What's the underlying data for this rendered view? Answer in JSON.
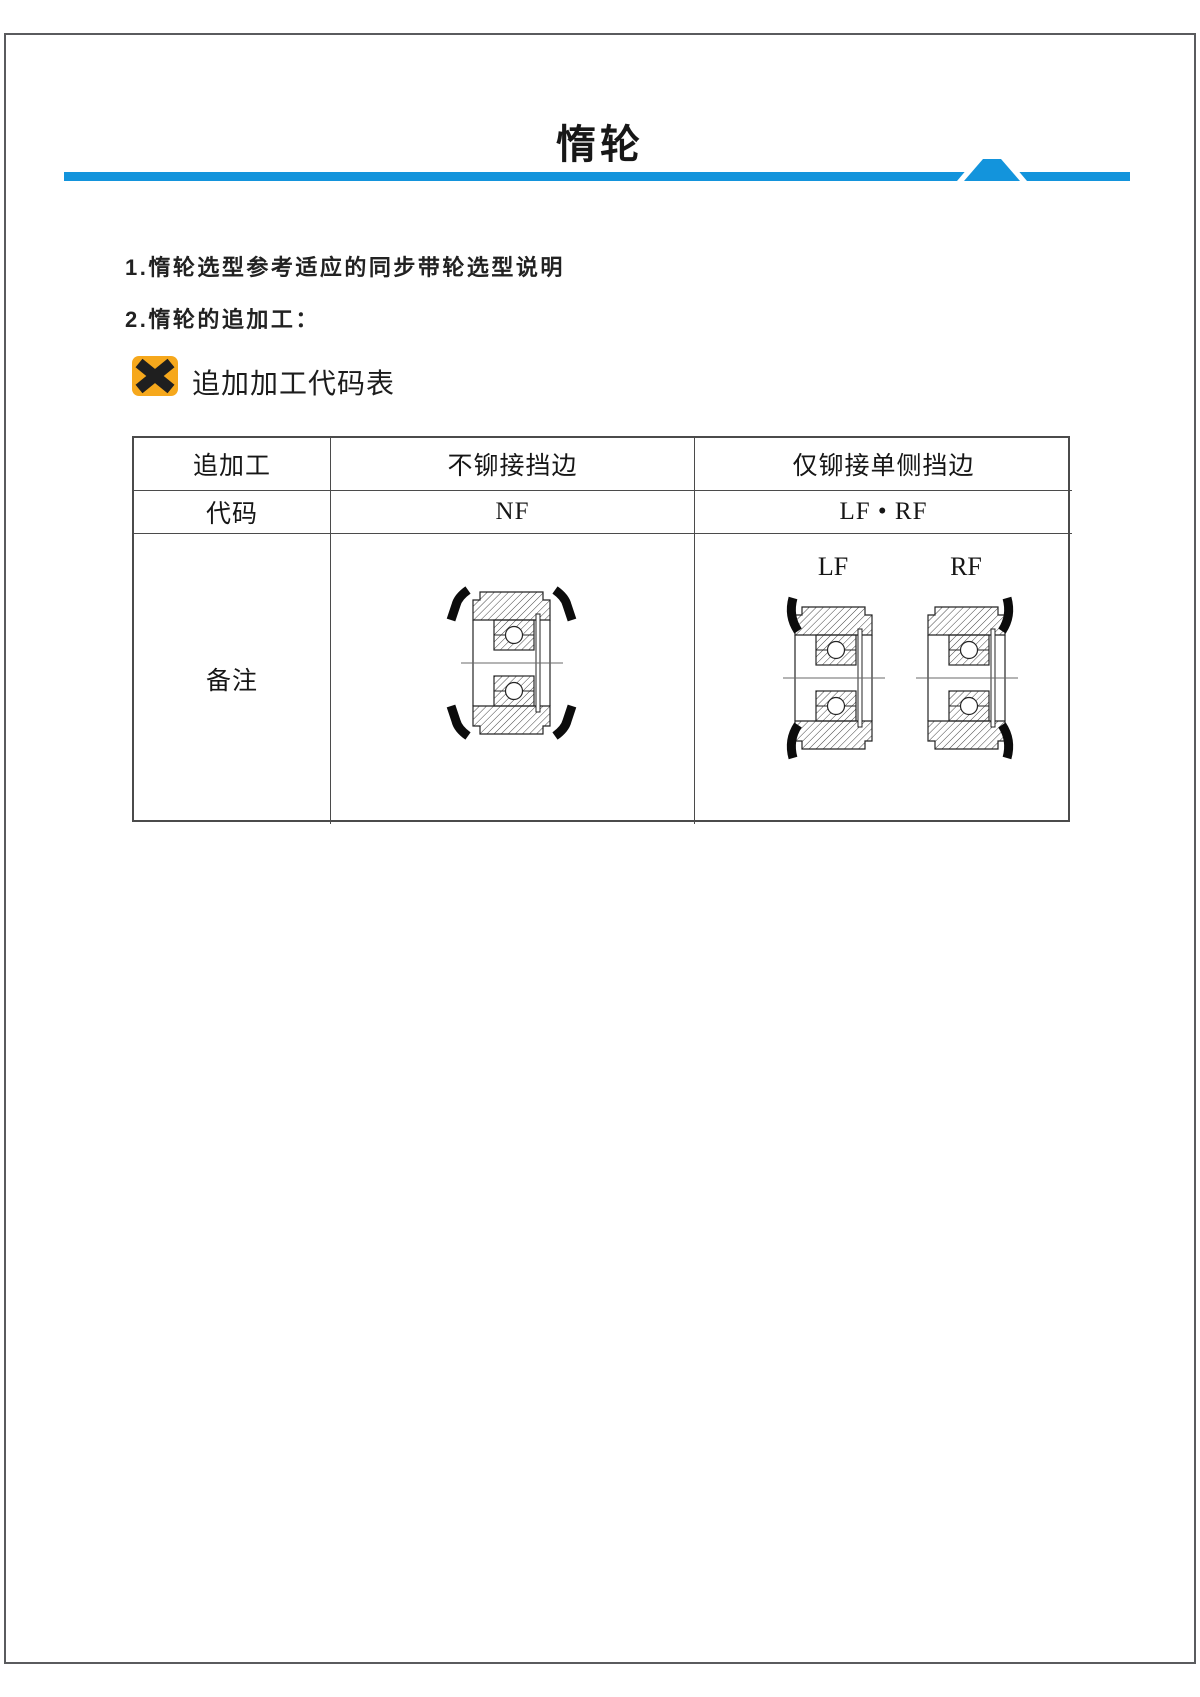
{
  "page": {
    "title": "惰轮",
    "accent_blue": "#1394DC",
    "frame_color": "#5a5b5e"
  },
  "notes": {
    "line1": "1.惰轮选型参考适应的同步带轮选型说明",
    "line2": "2.惰轮的追加工：",
    "table_caption": "追加加工代码表",
    "caption_icon": "x-mark-icon",
    "caption_icon_color": "#F6A81C"
  },
  "table": {
    "headers": {
      "addition": "追加工",
      "no_flange": "不铆接挡边",
      "single_flange": "仅铆接单侧挡边"
    },
    "codes": {
      "row_label": "代码",
      "no_flange_code": "NF",
      "single_flange_code": "LF • RF"
    },
    "remarks": {
      "row_label": "备注",
      "lf_label": "LF",
      "rf_label": "RF"
    }
  }
}
